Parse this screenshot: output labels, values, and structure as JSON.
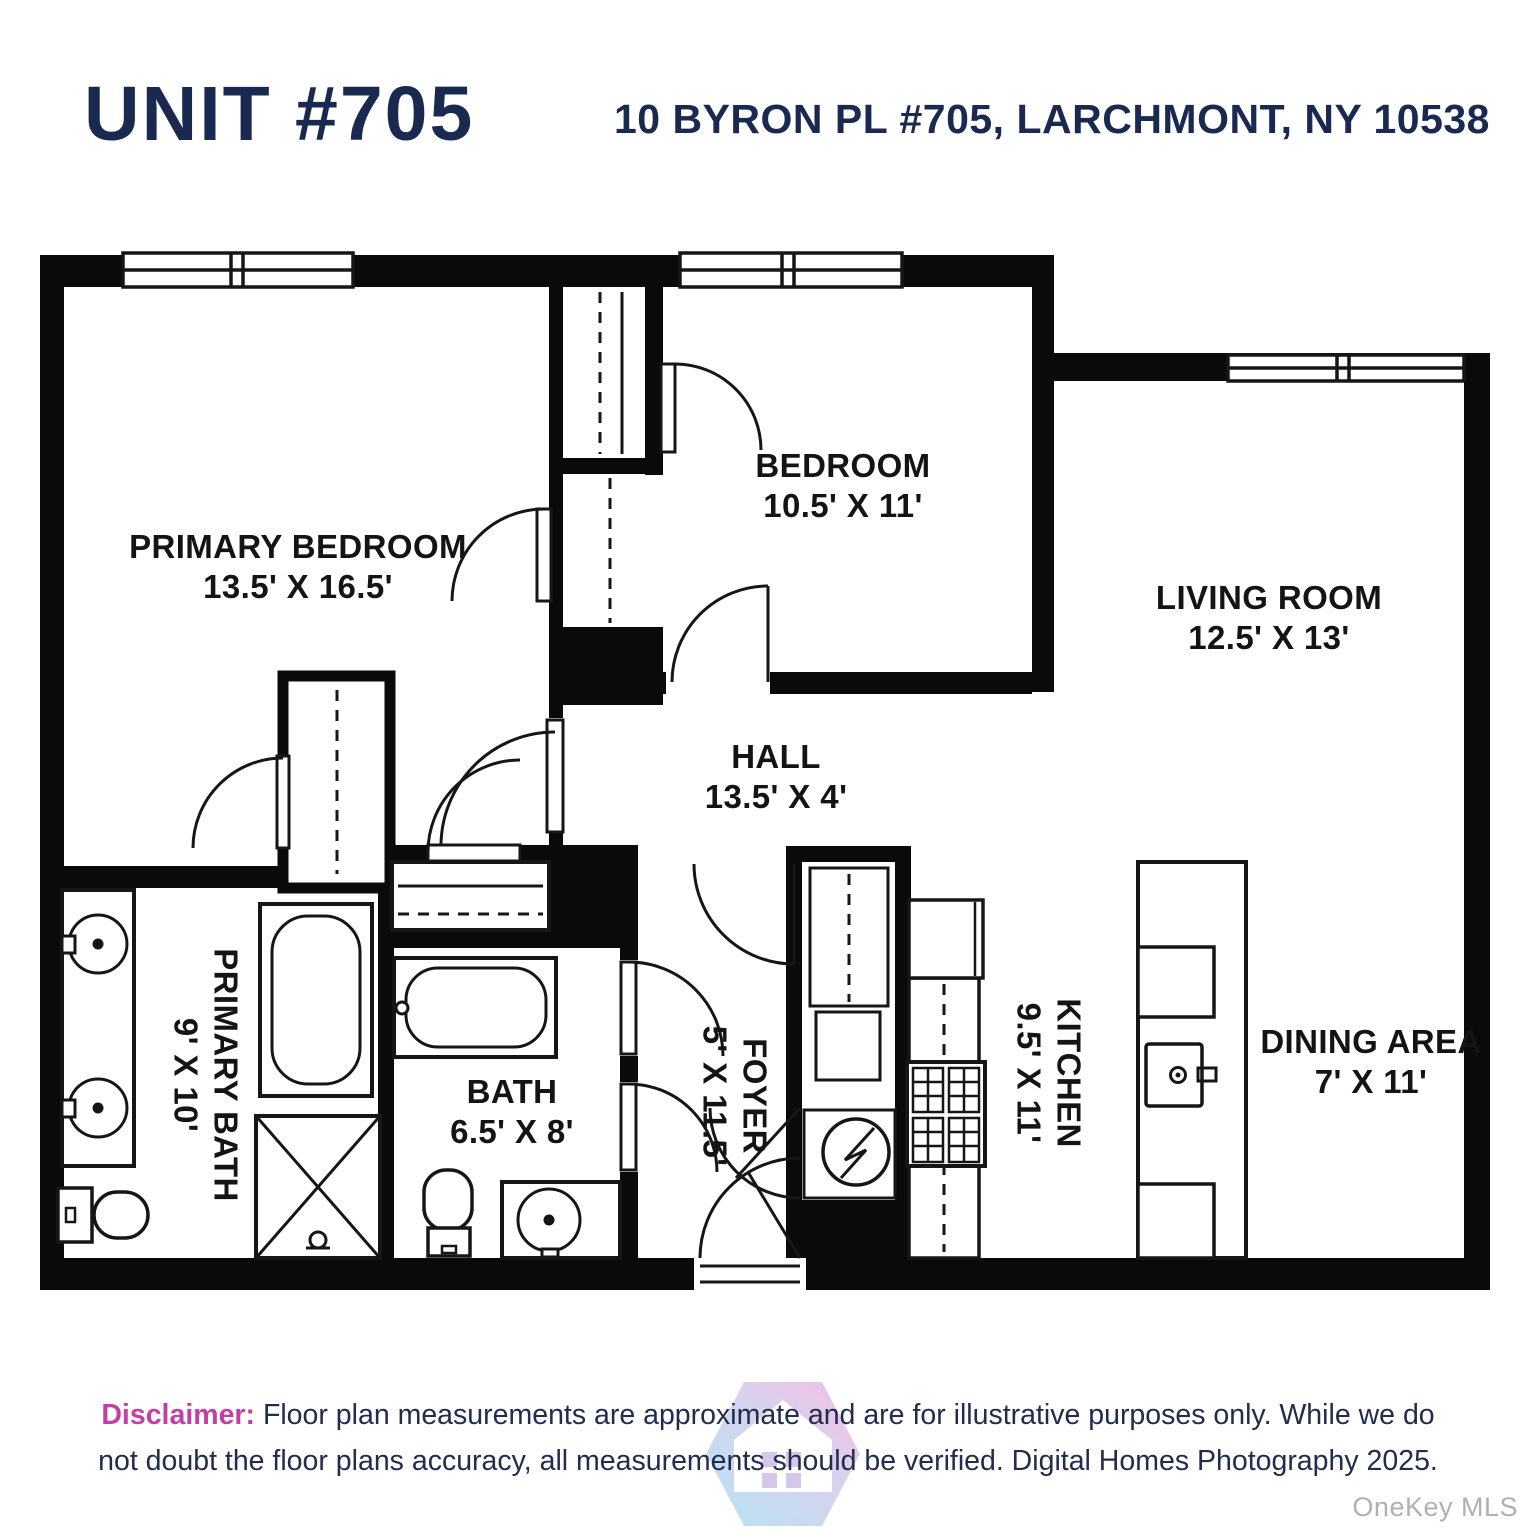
{
  "header": {
    "unit_title": "UNIT #705",
    "address": "10 BYRON PL #705, LARCHMONT, NY 10538"
  },
  "rooms": [
    {
      "name": "PRIMARY BEDROOM",
      "dims": "13.5' X 16.5'"
    },
    {
      "name": "BEDROOM",
      "dims": "10.5' X 11'"
    },
    {
      "name": "LIVING ROOM",
      "dims": "12.5' X 13'"
    },
    {
      "name": "HALL",
      "dims": "13.5' X 4'"
    },
    {
      "name": "PRIMARY BATH",
      "dims": "9' X 10'"
    },
    {
      "name": "BATH",
      "dims": "6.5' X 8'"
    },
    {
      "name": "FOYER",
      "dims": "5' X 11.5'"
    },
    {
      "name": "KITCHEN",
      "dims": "9.5' X 11'"
    },
    {
      "name": "DINING AREA",
      "dims": "7' X 11'"
    }
  ],
  "disclaimer": {
    "label": "Disclaimer:",
    "text": "Floor plan measurements are approximate and are for illustrative purposes only. While we do not doubt the floor plans accuracy, all measurements should be verified. Digital Homes Photography 2025."
  },
  "watermark": "OneKey MLS",
  "colors": {
    "title_navy": "#1a2950",
    "disclaimer_pink": "#c43fa5",
    "wall_black": "#0a0a0a",
    "watermark_gray": "#b2b0ad",
    "logo_blue": "#a9dcf1",
    "logo_pink": "#f2b1dd"
  }
}
